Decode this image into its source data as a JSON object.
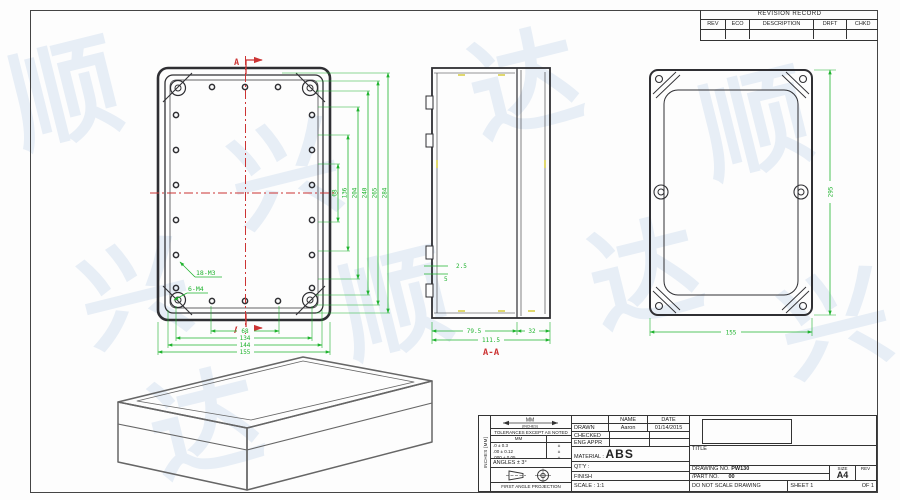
{
  "colors": {
    "dim_green": "#1fb32e",
    "center_red": "#cc3434",
    "line_dark": "#2f2f33",
    "hatch_yellow": "#d4c832",
    "iso_gray": "#666666",
    "watermark_blue": "#84aad6"
  },
  "watermark": {
    "glyphs": [
      "顺",
      "兴",
      "达"
    ]
  },
  "revision_table": {
    "title": "REVISION RECORD",
    "headers": [
      "REV",
      "ECO",
      "DESCRIPTION",
      "DRFT",
      "CHKD"
    ]
  },
  "top_view": {
    "section_label": "A",
    "label_m3": "18-M3",
    "label_m4": "6-M4",
    "right_dims": [
      "68",
      "136",
      "204",
      "240",
      "265",
      "284"
    ],
    "bottom_dims": [
      "68",
      "134",
      "144",
      "155"
    ]
  },
  "section_view": {
    "label": "A-A",
    "dim_base": "79.5",
    "dim_lid": "32",
    "dim_total": "111.5",
    "dim_wall": "2.5",
    "dim_rib": "5"
  },
  "lid_view": {
    "dim_length": "295",
    "dim_width": "155"
  },
  "title_block": {
    "side_label": "INCHES [MM]",
    "units_primary": "MM",
    "units_secondary": "(INCHES)",
    "tolerances_heading": "TOLERANCES EXCEPT AS NOTED",
    "tol_header": "MM",
    "tol_rows": [
      ".0 ± 0.3",
      ".00 ± 0.12",
      ".000 ± 0.05"
    ],
    "tol_marks": [
      "±",
      "±",
      "±"
    ],
    "angles": "ANGLES ± 3°",
    "projection": "FIRST ANGLE PROJECTION",
    "name_header": "NAME",
    "date_header": "DATE",
    "drawn_label": "DRAWN",
    "drawn_name": "Aaron",
    "drawn_date": "01/14/2015",
    "checked_label": "CHECKED",
    "eng_appr_label": "ENG APPR",
    "material_label": "MATERIAL :",
    "material_value": "ABS",
    "qty_label": "QT'Y :",
    "finish_label": "FINISH",
    "scale_label": "SCALE :",
    "scale_value": "1:1",
    "title_label": "TITLE",
    "drawing_no_label": "DRAWING NO.",
    "drawing_no": "PW130",
    "part_no_label": "/PART NO.",
    "part_no": "00",
    "size_label": "SIZE",
    "size_value": "A4",
    "rev_label": "REV",
    "do_not_scale": "DO NOT SCALE DRAWING",
    "sheet_text": "SHEET 1",
    "of_text": "OF 1"
  }
}
